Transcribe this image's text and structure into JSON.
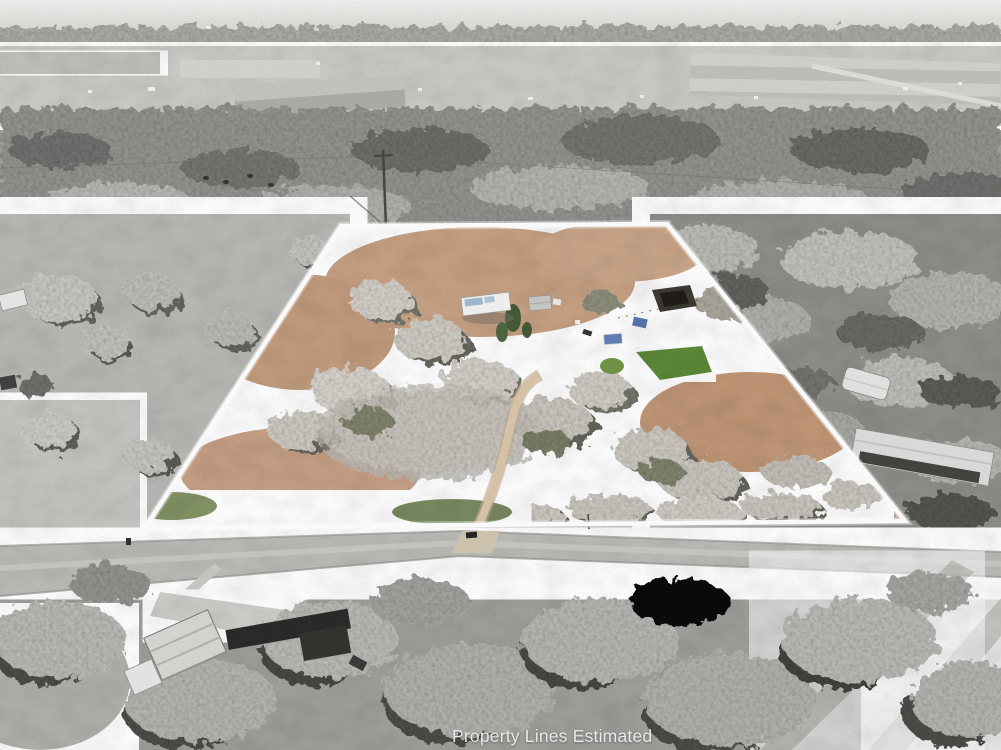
{
  "photo": {
    "caption": "Property Lines Estimated",
    "caption_color": "#e9e9e9",
    "boundary": {
      "points": "341,226 667,224 905,521 145,528",
      "stroke_color": "#ffffff"
    },
    "palette": {
      "sky_haze": "#eeeeec",
      "distant_fields": "#c9c9c5",
      "tree_band": "#8f8f8b",
      "pasture": "#b6b6b2",
      "road": "#b9b9b5",
      "parcel_ground": "#b49a82",
      "parcel_leaf_litter": "#c59d7e",
      "parcel_lawn": "#55842f",
      "parcel_pine": "#3c5330",
      "tarp_blue": "#4e6ea6",
      "frosted_canopy": "#d3cec7",
      "dark_roof": "#21211f",
      "white_roof": "#f2f2f0"
    }
  }
}
